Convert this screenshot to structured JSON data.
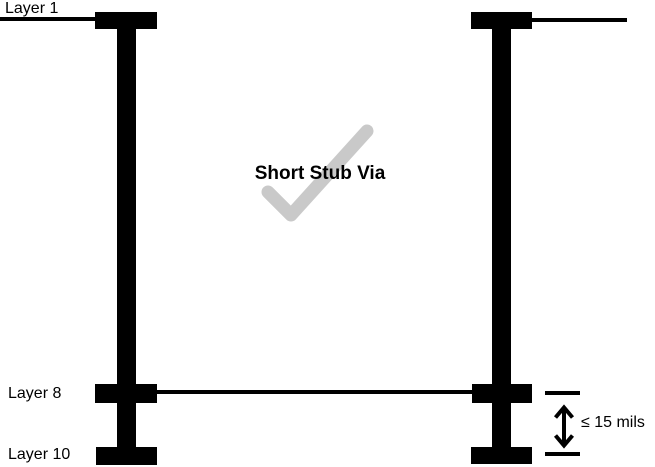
{
  "title": "Short Stub Via",
  "labels": {
    "layer1": "Layer 1",
    "layer8": "Layer 8",
    "layer10": "Layer 10"
  },
  "dimension": {
    "label": "≤ 15 mils"
  },
  "icons": {
    "checkmark": "check-icon",
    "dimension_arrow": "double-vertical-arrow-icon"
  },
  "colors": {
    "via": "#000000",
    "checkmark": "#c9c9c9",
    "background": "#ffffff",
    "text": "#000000"
  }
}
